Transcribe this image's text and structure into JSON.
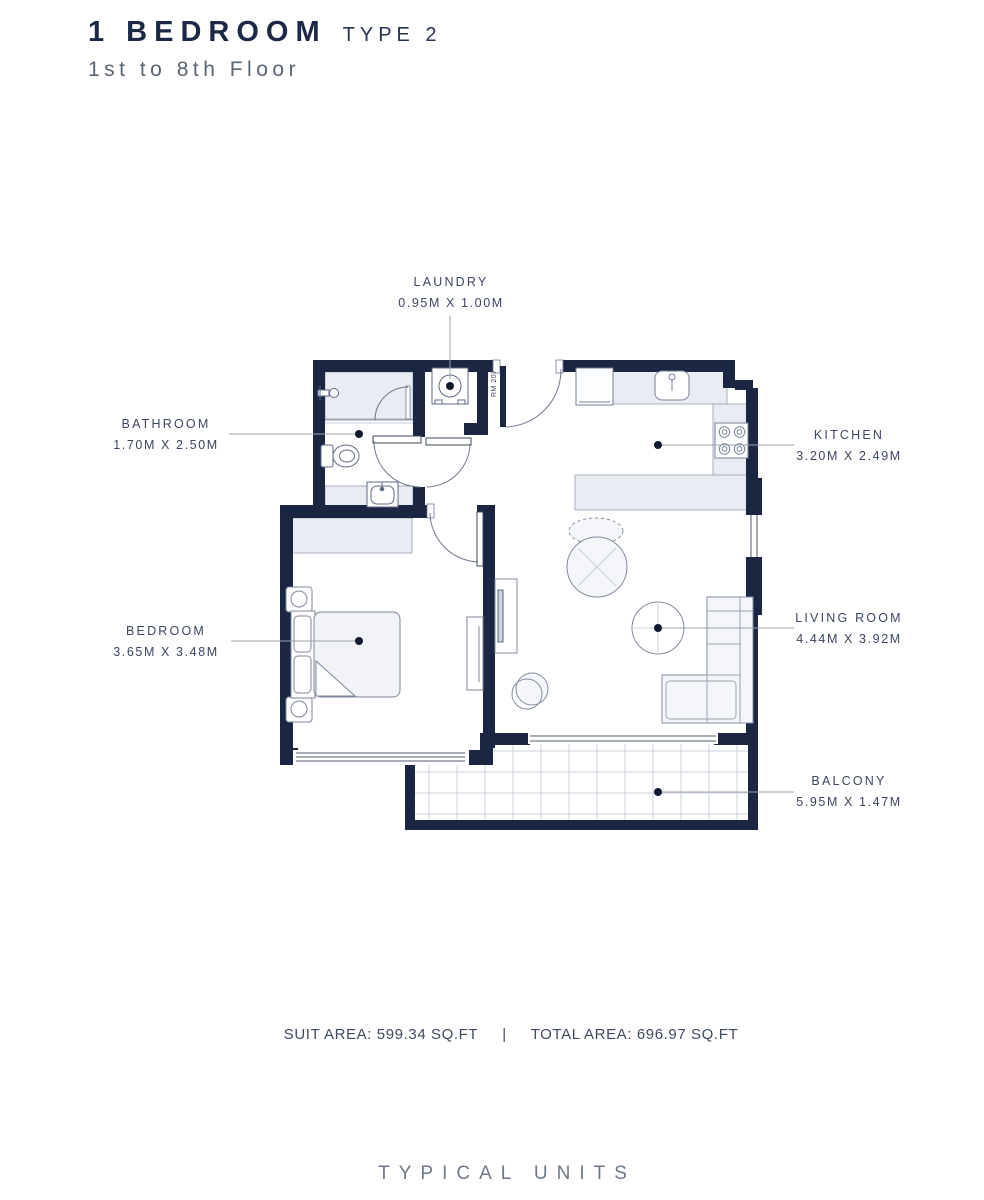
{
  "header": {
    "title": "1 BEDROOM",
    "type": "TYPE 2",
    "subtitle": "1st to 8th Floor"
  },
  "rooms": {
    "laundry": {
      "name": "LAUNDRY",
      "dims": "0.95M X 1.00M"
    },
    "bathroom": {
      "name": "BATHROOM",
      "dims": "1.70M X 2.50M"
    },
    "kitchen": {
      "name": "KITCHEN",
      "dims": "3.20M X 2.49M"
    },
    "bedroom": {
      "name": "BEDROOM",
      "dims": "3.65M X 3.48M"
    },
    "living_room": {
      "name": "LIVING ROOM",
      "dims": "4.44M X 3.92M"
    },
    "balcony": {
      "name": "BALCONY",
      "dims": "5.95M X 1.47M"
    }
  },
  "plan": {
    "unit_label": "RM 207"
  },
  "footer": {
    "suit_area": "SUIT AREA: 599.34 SQ.FT",
    "divider": "|",
    "total_area": "TOTAL AREA: 696.97 SQ.FT"
  },
  "page_footer": {
    "label": "TYPICAL UNITS"
  },
  "colors": {
    "wall": "#1a2642",
    "counter_fill": "#e9ecf2",
    "label_text": "#3b4660",
    "muted_text": "#6e7887",
    "leader": "#9aa3b2"
  }
}
